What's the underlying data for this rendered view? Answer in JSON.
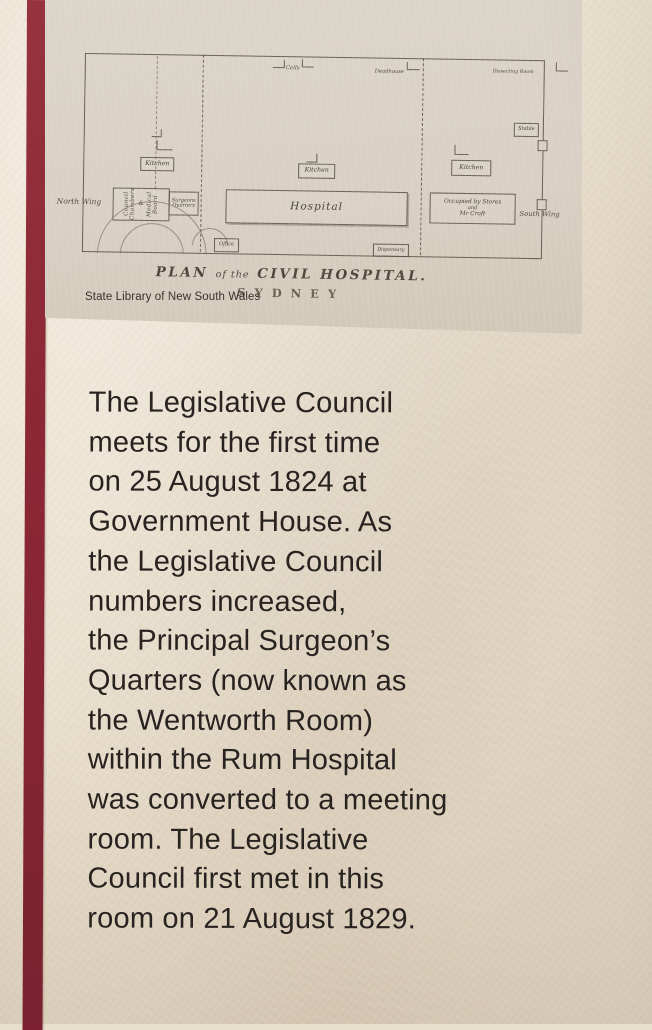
{
  "photo": {
    "type": "museum wall panel photograph",
    "colors": {
      "wall": "#e9dfcd",
      "stripe_maroon": "#8c2834",
      "paper": "#d8d0c3",
      "plan_ink": "#554c41",
      "caption_text": "#282320"
    }
  },
  "plan_card": {
    "title": {
      "word_plan": "PLAN",
      "of_the": "of the",
      "rest": "CIVIL HOSPITAL."
    },
    "subtitle": "SYDNEY",
    "credit": "State Library of New South Wales",
    "labels": {
      "north_wing": "North Wing",
      "south_wing": "South Wing",
      "kitchen_left": "Kitchen",
      "kitchen_middle": "Kitchen",
      "kitchen_right": "Kitchen",
      "hospital": "Hospital",
      "cells": "Cells",
      "deadhouse": "Deadhouse",
      "dissecting_room": "Dissecting Room",
      "stable": "Stable",
      "office": "Office",
      "dispensary": "Dispensary",
      "council_line_a": "Council Chambers",
      "council_amp": "&",
      "council_line_b": "Medical Board",
      "surgeons": "Surgeons",
      "quarters": "Quarters",
      "occupied_1": "Occupied by Stores",
      "occupied_2": "and",
      "occupied_3": "Mr Croft"
    }
  },
  "caption": {
    "lines": [
      "The Legislative Council",
      "meets for the first time",
      "on 25 August 1824 at",
      "Government House. As",
      "the Legislative Council",
      "numbers increased,",
      "the Principal Surgeon’s",
      "Quarters (now known as",
      "the Wentworth Room)",
      "within the Rum Hospital",
      "was converted to a meeting",
      "room. The Legislative",
      "Council first met in this",
      "room on 21 August 1829."
    ]
  }
}
